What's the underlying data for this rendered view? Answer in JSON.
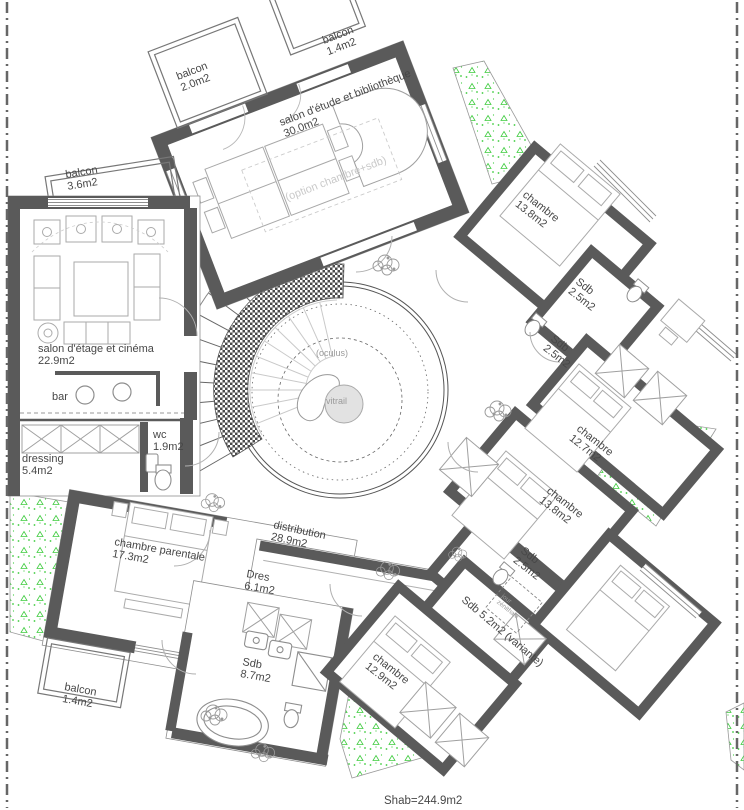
{
  "plan": {
    "kind": "floor-plan-etage",
    "total_area_label": "Shab=244.9m2"
  },
  "colors": {
    "wall": "#5a5a5a",
    "furniture": "#b0b0b0",
    "thin": "#8e8e8e",
    "green": "#3ecc3e",
    "faint": "#c9c9c9",
    "muted": "#9a9a9a",
    "text": "#474747",
    "vitrail": "#e2e2e2"
  },
  "labels": [
    {
      "name": "balcon-top-left",
      "lines": [
        "balcon",
        "2.0m2"
      ],
      "x": 178,
      "y": 80,
      "rot": -21
    },
    {
      "name": "balcon-top-right",
      "lines": [
        "balcon",
        "1.4m2"
      ],
      "x": 324,
      "y": 44,
      "rot": -21
    },
    {
      "name": "salon-etude",
      "lines": [
        "salon d'étude et bibliothèque",
        "30.0m2"
      ],
      "x": 281,
      "y": 126,
      "rot": -21
    },
    {
      "name": "option-chambre-sdb",
      "lines": [
        "(option chambre+sdb)"
      ],
      "x": 287,
      "y": 201,
      "rot": -21,
      "color": "faint"
    },
    {
      "name": "balcon-west",
      "lines": [
        "balcon",
        "3.6m2"
      ],
      "x": 66,
      "y": 178,
      "rot": -9
    },
    {
      "name": "chambre-nord-est",
      "lines": [
        "chambre",
        "13.8m2"
      ],
      "x": 522,
      "y": 196,
      "rot": 38
    },
    {
      "name": "sdb-nord-est-1",
      "lines": [
        "Sdb",
        "2.5m2"
      ],
      "x": 575,
      "y": 283,
      "rot": 38
    },
    {
      "name": "sdb-nord-est-2",
      "lines": [
        "Sdb",
        "2.5m2"
      ],
      "x": 550,
      "y": 340,
      "rot": 38
    },
    {
      "name": "chambre-est",
      "lines": [
        "chambre",
        "12.7m2"
      ],
      "x": 576,
      "y": 430,
      "rot": 38
    },
    {
      "name": "chambre-sud-est",
      "lines": [
        "chambre",
        "13.8m2"
      ],
      "x": 546,
      "y": 492,
      "rot": 38
    },
    {
      "name": "sdb-sud-est",
      "lines": [
        "Sdb",
        "2.5m2"
      ],
      "x": 520,
      "y": 552,
      "rot": 38
    },
    {
      "name": "jour-zenithale",
      "lines": [
        "jour",
        "zénithale"
      ],
      "x": 501,
      "y": 597,
      "rot": 38,
      "size": 6.5,
      "color": "muted"
    },
    {
      "name": "sdb-variante",
      "lines": [
        "Sdb  5.2m2  (variante)"
      ],
      "x": 461,
      "y": 601,
      "rot": 40
    },
    {
      "name": "chambre-sud",
      "lines": [
        "chambre",
        "12.9m2"
      ],
      "x": 372,
      "y": 658,
      "rot": 38
    },
    {
      "name": "salon-etage-cinema",
      "lines": [
        "salon d'étage et cinéma",
        "22.9m2"
      ],
      "x": 38,
      "y": 352,
      "rot": 0
    },
    {
      "name": "bar",
      "lines": [
        "bar"
      ],
      "x": 52,
      "y": 400,
      "rot": 0
    },
    {
      "name": "dressing",
      "lines": [
        "dressing",
        "5.4m2"
      ],
      "x": 22,
      "y": 462,
      "rot": 0
    },
    {
      "name": "wc",
      "lines": [
        "wc",
        "1.9m2"
      ],
      "x": 153,
      "y": 438,
      "rot": 0
    },
    {
      "name": "chambre-parentale",
      "lines": [
        "chambre parentale",
        "17.3m2"
      ],
      "x": 114,
      "y": 545,
      "rot": 10
    },
    {
      "name": "distribution",
      "lines": [
        "distribution",
        "28.9m2"
      ],
      "x": 273,
      "y": 528,
      "rot": 12
    },
    {
      "name": "dres",
      "lines": [
        "Dres",
        "6.1m2"
      ],
      "x": 246,
      "y": 577,
      "rot": 10
    },
    {
      "name": "sdb-principale",
      "lines": [
        "Sdb",
        "8.7m2"
      ],
      "x": 242,
      "y": 665,
      "rot": 10
    },
    {
      "name": "balcon-sud",
      "lines": [
        "balcon",
        "1.4m2"
      ],
      "x": 64,
      "y": 690,
      "rot": 10
    },
    {
      "name": "oculus",
      "lines": [
        "(oculus)"
      ],
      "x": 316,
      "y": 356,
      "rot": 0,
      "size": 9,
      "color": "muted"
    },
    {
      "name": "vitrail",
      "lines": [
        "vitrail"
      ],
      "x": 326,
      "y": 404,
      "rot": 0,
      "size": 9,
      "color": "muted"
    },
    {
      "name": "shab-total",
      "lines": [
        "Shab=244.9m2"
      ],
      "x": 384,
      "y": 804,
      "rot": 0,
      "size": 11.5
    }
  ]
}
